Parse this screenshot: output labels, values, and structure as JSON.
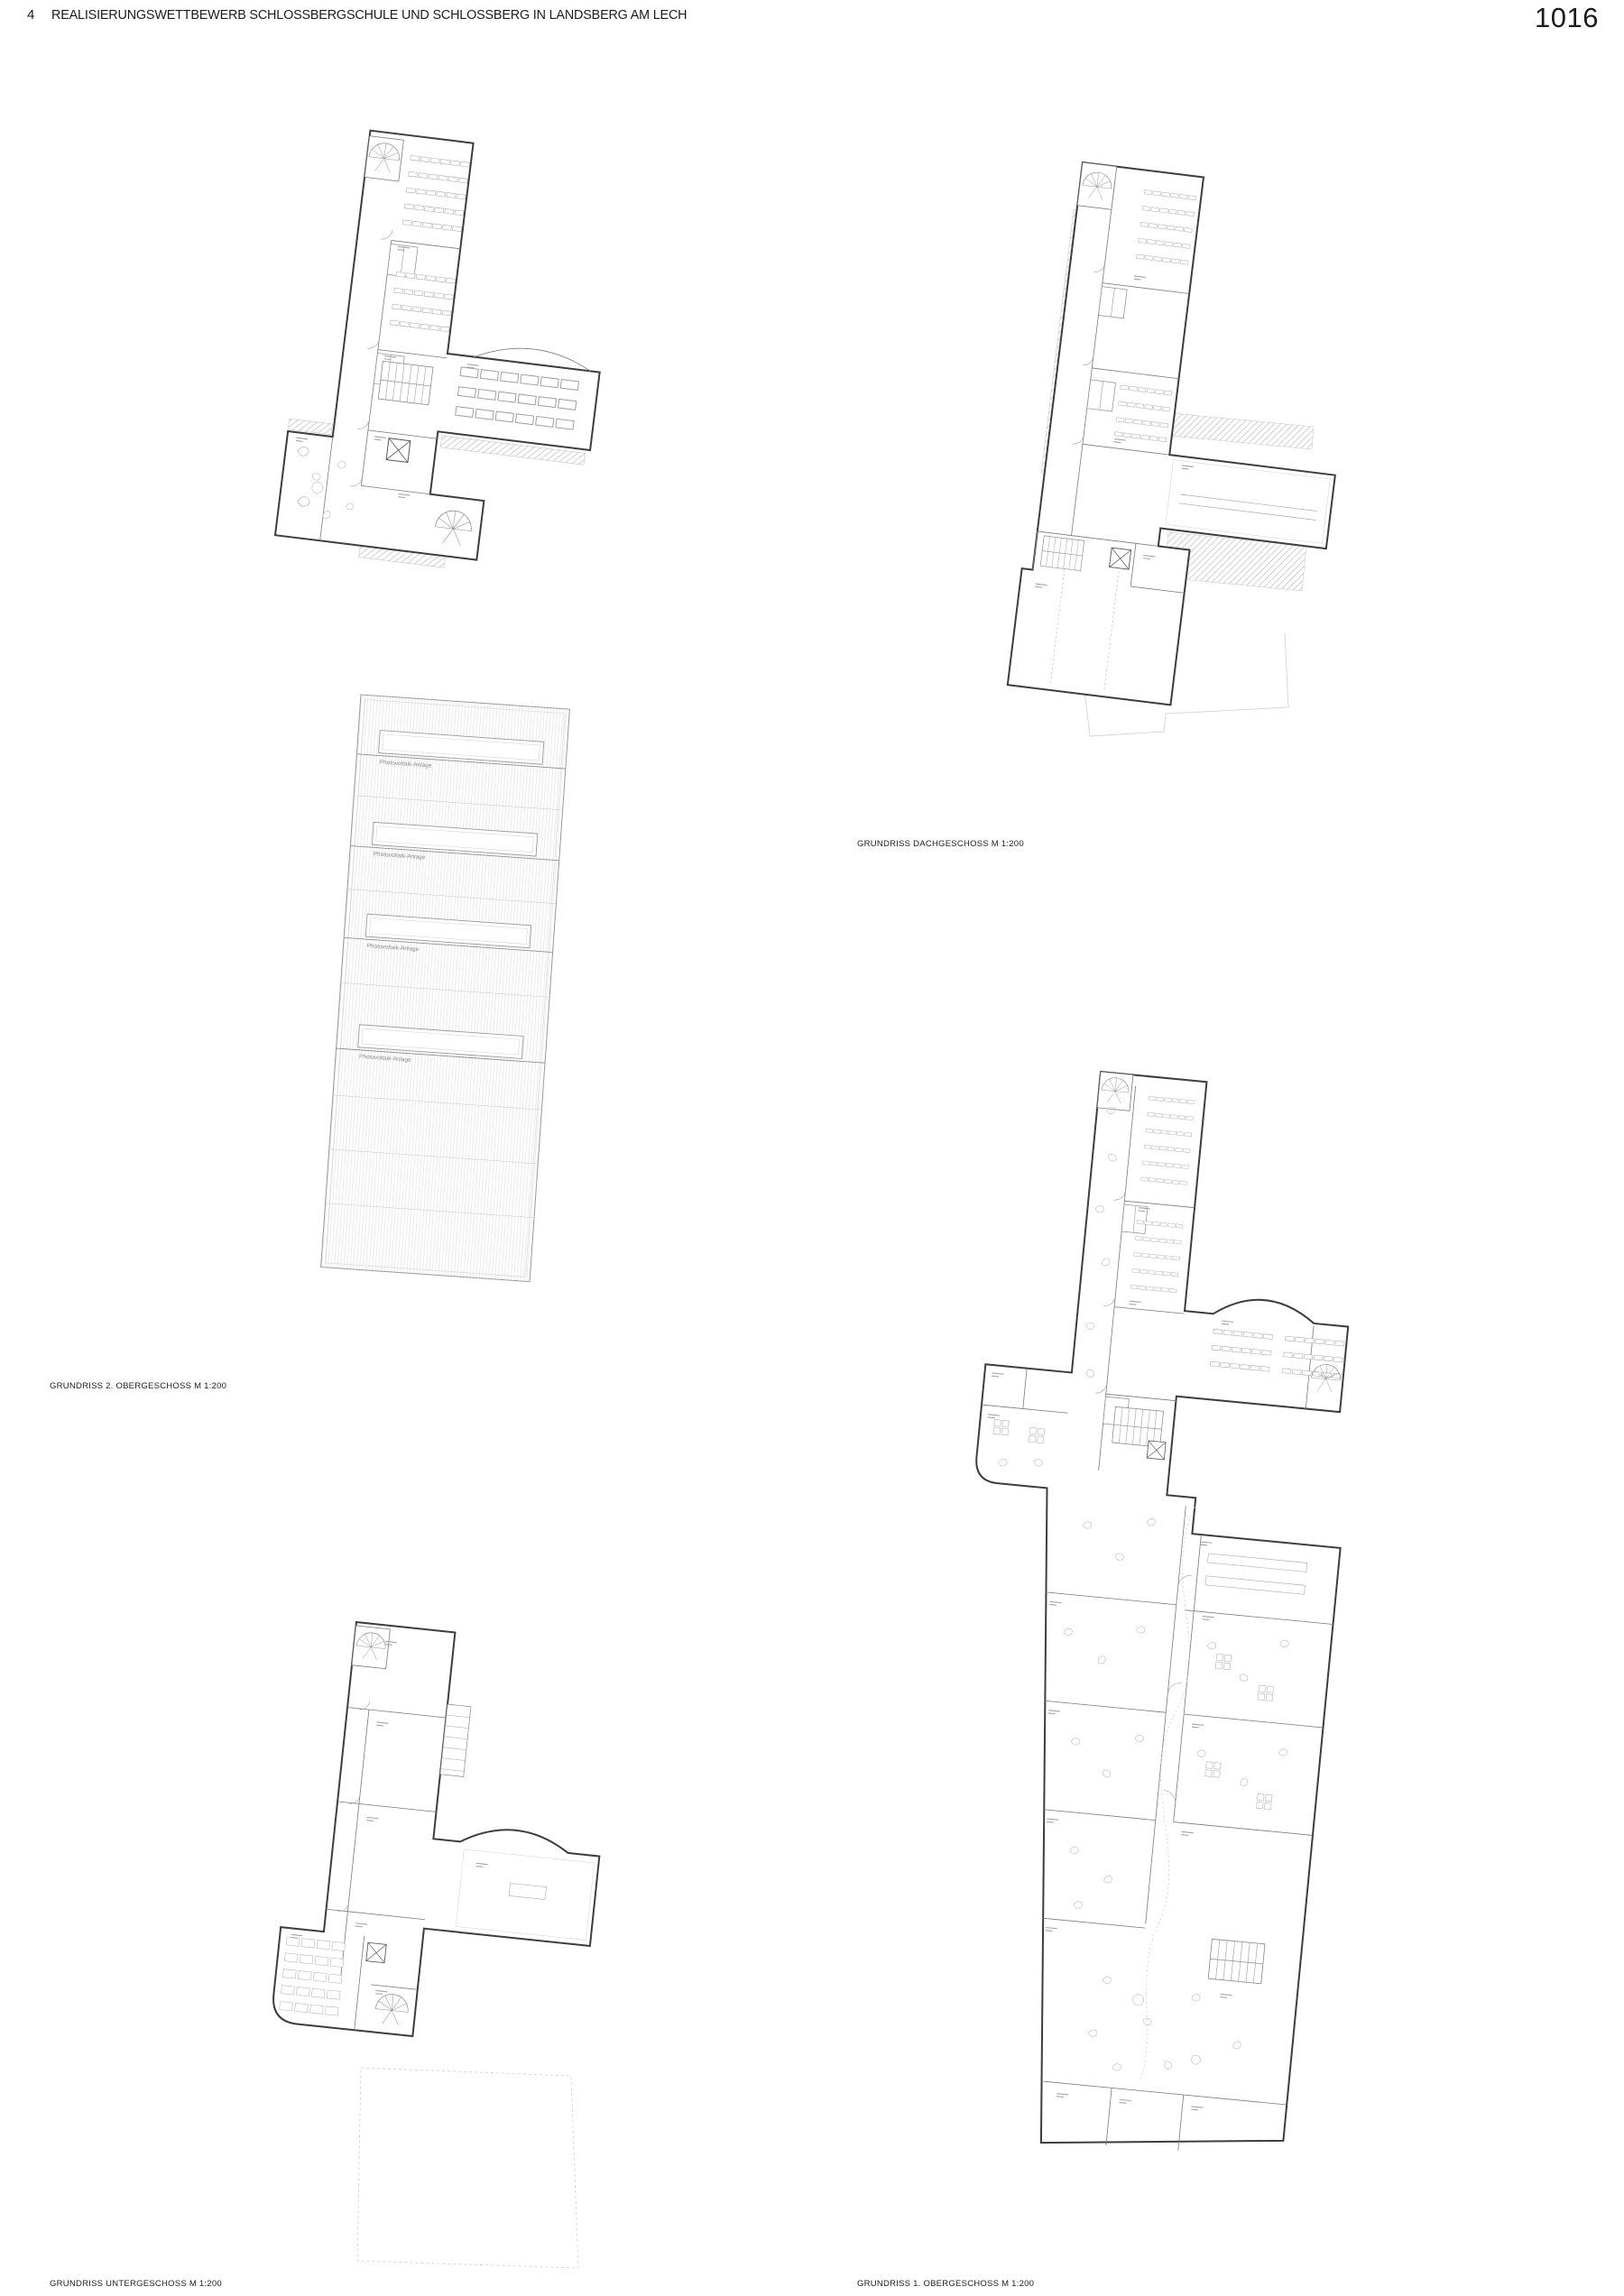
{
  "page": {
    "sheet_number": "4",
    "title": "REALISIERUNGSWETTBEWERB SCHLOSSBERGSCHULE UND SCHLOSSBERG IN LANDSBERG AM LECH",
    "page_number": "1016"
  },
  "plans": {
    "og2": {
      "caption": "GRUNDRISS 2. OBERGESCHOSS  M 1:200"
    },
    "dg": {
      "caption": "GRUNDRISS DACHGESCHOSS  M 1:200"
    },
    "ug": {
      "caption": "GRUNDRISS UNTERGESCHOSS  M 1:200"
    },
    "og1": {
      "caption": "GRUNDRISS 1. OBERGESCHOSS  M 1:200"
    }
  },
  "roof": {
    "skylight_label": "Photovoltaik-Anlage"
  }
}
